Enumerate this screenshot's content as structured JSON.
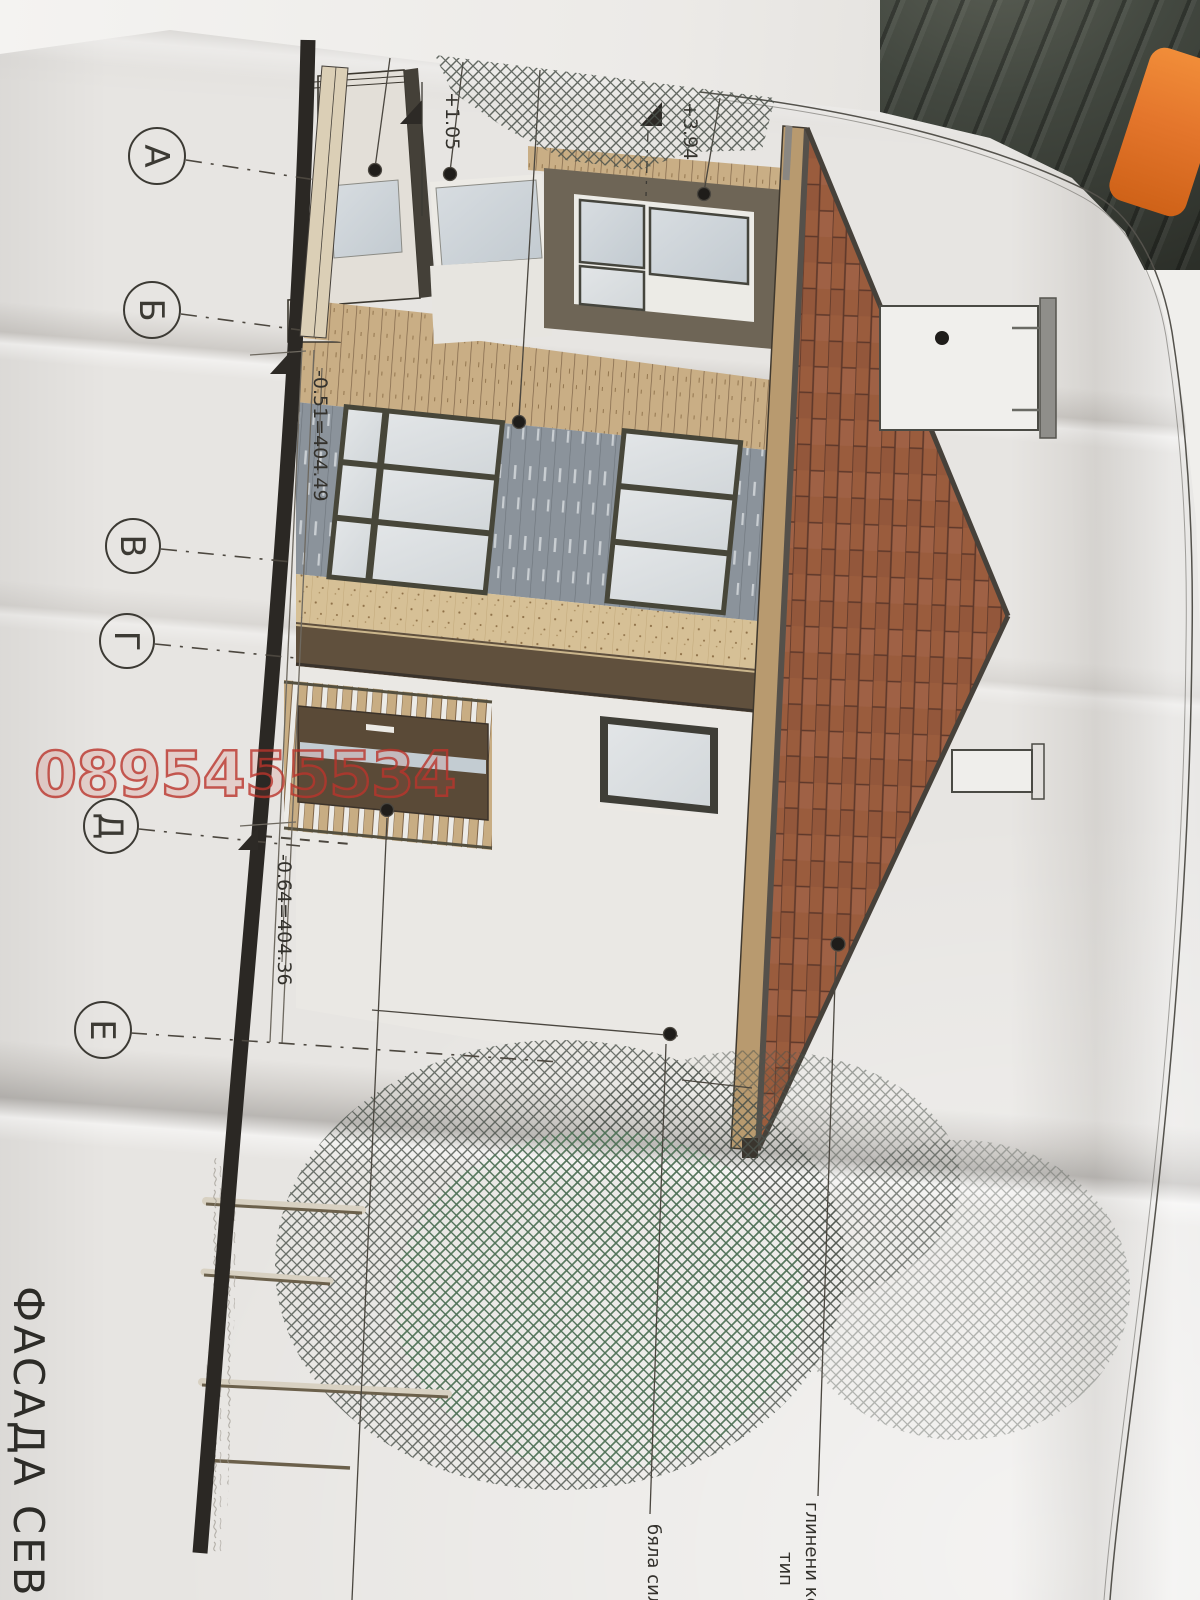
{
  "title": {
    "text": "ФАСАДА СЕВЕ"
  },
  "axes": {
    "labels": [
      "А",
      "Б",
      "В",
      "Г",
      "Д",
      "Е"
    ]
  },
  "levels": {
    "balcony": "+1.05",
    "attic": "+3.94",
    "grade_upper": "-0.51=404.49",
    "grade_lower": "-0.64=404.36"
  },
  "annotations": {
    "roof_material_line1": "глинени кер",
    "roof_material_line2": "тип",
    "wall_material": "бяла сил"
  },
  "watermark": {
    "text": "0895455534"
  },
  "palette": {
    "paper": "#e7e5e2",
    "roof_tile": "#9a5c3d",
    "wood_band": "#c9ae85",
    "soffit": "#d6c096",
    "fascia_brown": "#5f4f3c",
    "gray_plank": "#8b939b",
    "door_brown": "#5a4a37",
    "glass": "#ccd3d8",
    "watermark_red": "#ba342c",
    "orange_object": "#e4762c",
    "fabric_dark": "#3e4039",
    "line_dark": "#3a362f"
  }
}
